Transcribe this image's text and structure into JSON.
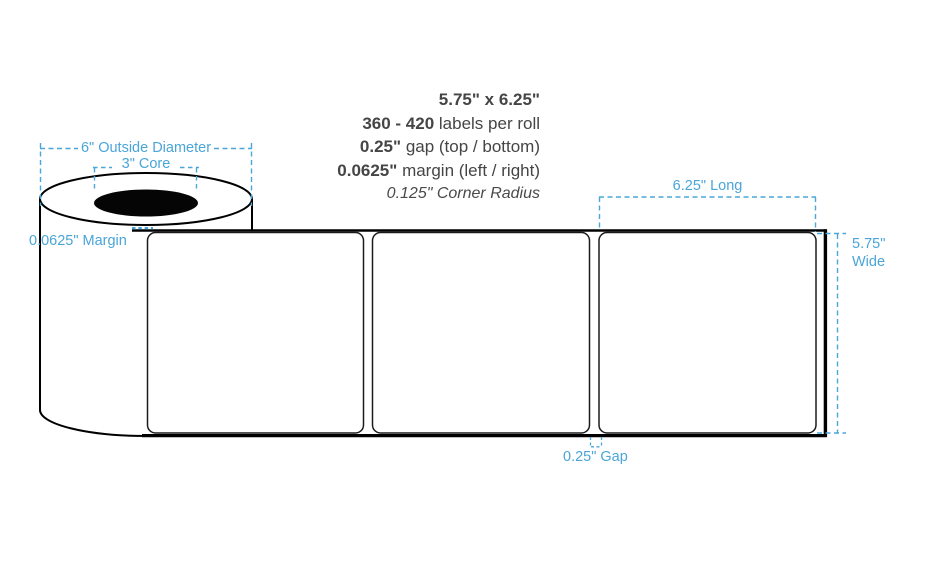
{
  "colors": {
    "dimension_blue": "#4AA5D8",
    "ink": "#454545",
    "outline": "#000000"
  },
  "specs": {
    "size": "5.75\" x 6.25\"",
    "count_value": "360 - 420",
    "count_label": "labels per roll",
    "gap_value": "0.25\"",
    "gap_label": "gap (top / bottom)",
    "margin_value": "0.0625\"",
    "margin_label": "margin (left / right)",
    "corner_radius": "0.125\" Corner Radius"
  },
  "dimensions": {
    "outside_diameter": "6\" Outside Diameter",
    "core": "3\" Core",
    "side_margin": "0.0625\" Margin",
    "label_length": "6.25\" Long",
    "label_width_value": "5.75\"",
    "label_width_word": "Wide",
    "gap": "0.25\" Gap"
  },
  "diagram": {
    "labels_shown": 3
  }
}
